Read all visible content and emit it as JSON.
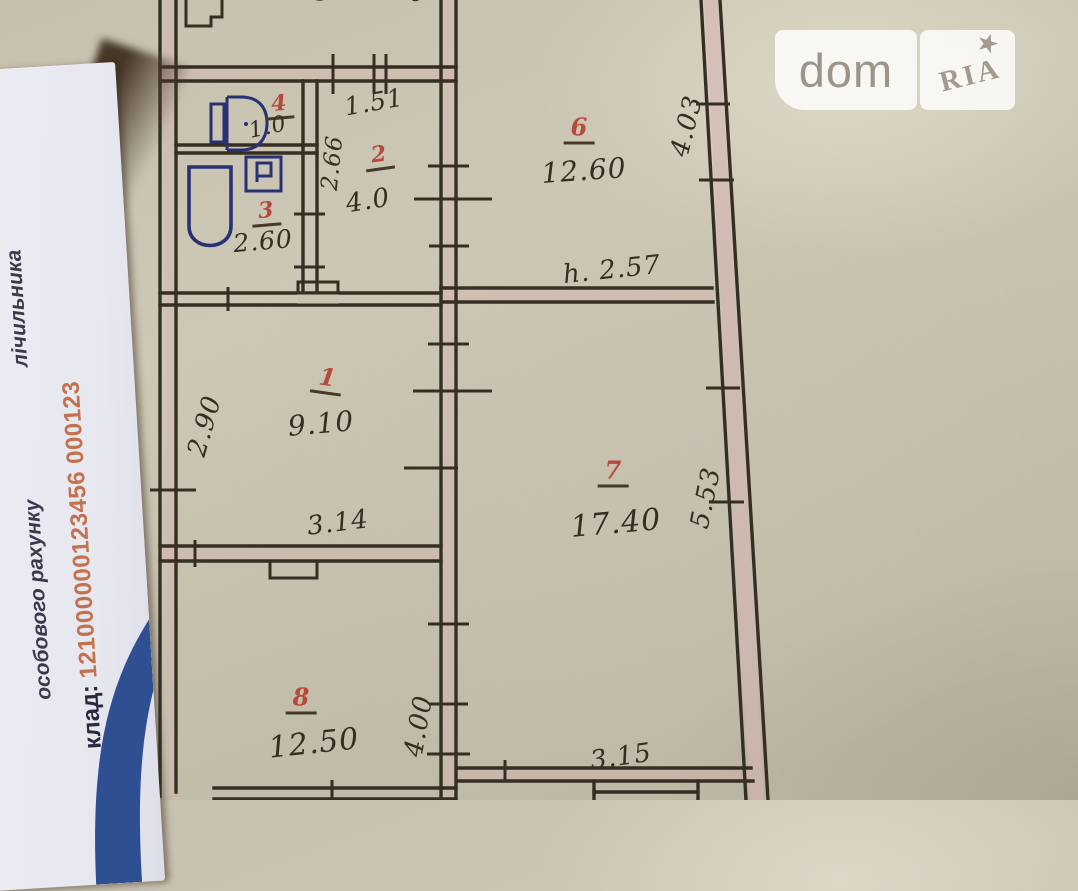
{
  "watermark": {
    "brand_left": "dom",
    "brand_right": "RIA",
    "star": "★"
  },
  "side_card": {
    "form_text_top": "лічильника",
    "form_text_bottom": "особового рахунку",
    "account_label": "клад:",
    "account_number": "121000000123456 000123"
  },
  "floor_plan": {
    "rooms": [
      {
        "number": "1",
        "area": "9.10"
      },
      {
        "number": "2",
        "area": "4.0"
      },
      {
        "number": "3",
        "area": "2.60"
      },
      {
        "number": "4",
        "area": "1.0"
      },
      {
        "number": "6",
        "area": "12.60"
      },
      {
        "number": "7",
        "area": "17.40"
      },
      {
        "number": "8",
        "area": "12.50"
      }
    ],
    "dimensions": {
      "top_left_width": "3.60",
      "top_left_mark": "б",
      "room6_width_top": "3.15",
      "room6_depth": "4.03",
      "ceiling_height": "h. 2.57",
      "hall_door_width": "1.51",
      "hall_depth": "2.66",
      "room1_depth": "2.90",
      "room1_width": "3.14",
      "room7_depth": "5.53",
      "room7_width": "3.15",
      "room8_depth": "4.00"
    }
  },
  "colors": {
    "ink": "#362e23",
    "room_number_ink": "#b54a3d",
    "fixture_ink": "#283173",
    "paper": "#c6c0ae",
    "card_swoosh": "#2e4f92",
    "account_number": "#c4714e"
  }
}
